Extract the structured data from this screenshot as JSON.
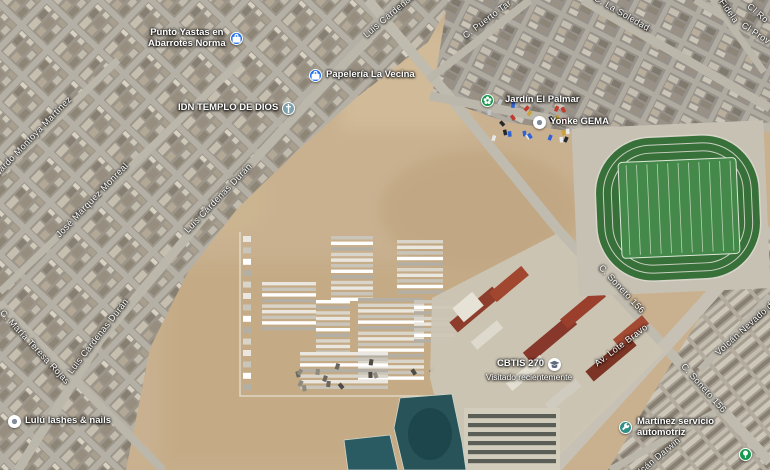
{
  "map": {
    "view": "satellite",
    "pois": [
      {
        "name": "punto-yastas",
        "line1": "Punto Yastas en",
        "line2": "Abarrotes Norma",
        "icon": "bag-icon",
        "color": "#1e6ef0"
      },
      {
        "name": "papeleria-la-vecina",
        "label": "Papelería La Vecina",
        "icon": "bag-icon",
        "color": "#1e6ef0"
      },
      {
        "name": "idn-templo-de-dios",
        "label": "IDN TEMPLO DE DIOS",
        "icon": "church-icon",
        "color": "#7ba1ae"
      },
      {
        "name": "jardin-el-palmar",
        "label": "Jardín El Palmar",
        "icon": "flower-icon",
        "color": "#17994e"
      },
      {
        "name": "yonke-gema",
        "label": "Yonke GEMA",
        "icon": "dot-icon",
        "color": "#ffffff"
      },
      {
        "name": "cbtis-270",
        "label": "CBTIS 270",
        "sub": "Visitado recientemente",
        "icon": "school-icon",
        "color": "#ffffff"
      },
      {
        "name": "lulu-lashes-nails",
        "label": "Lulú lashes & nails",
        "icon": "dot-icon",
        "color": "#ffffff"
      },
      {
        "name": "martinez-servicio",
        "line1": "Martínez servicio",
        "line2": "automotriz",
        "icon": "wrench-icon",
        "color": "#2f8f85"
      },
      {
        "name": "park-place",
        "icon": "tree-icon",
        "color": "#17994e"
      }
    ],
    "streets": [
      {
        "text": "Ricardo Montoya Martínez"
      },
      {
        "text": "José Márquez Monreal"
      },
      {
        "text": "Luis Cárdenas Durán"
      },
      {
        "text": "Luis Cárdenas Durán"
      },
      {
        "text": "Luis Cárdenas Durán"
      },
      {
        "text": "C. María Teresa Rojas"
      },
      {
        "text": "C. Puerto Tar"
      },
      {
        "text": "C. La Soledad"
      },
      {
        "text": "Fidela"
      },
      {
        "text": "Cl Prov"
      },
      {
        "text": "C. Soneto 156"
      },
      {
        "text": "C. Soneto 156"
      },
      {
        "text": "Av. Lote Bravo"
      },
      {
        "text": "Volcán Nevado de"
      },
      {
        "text": "Volcán Darwin"
      },
      {
        "text": "Cl Ro"
      }
    ]
  }
}
